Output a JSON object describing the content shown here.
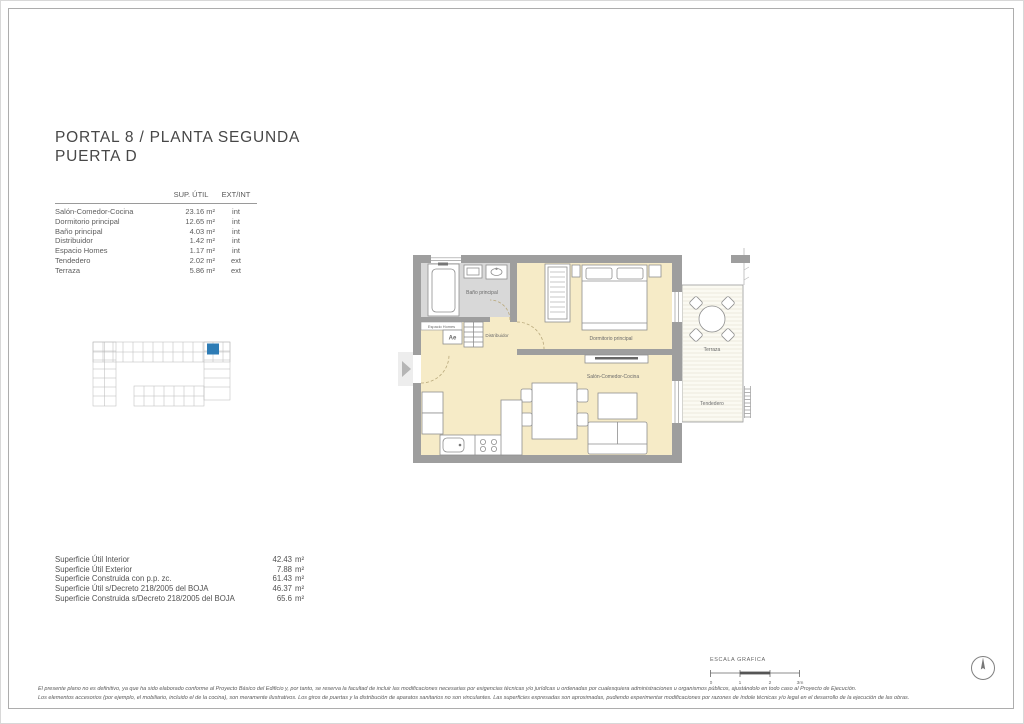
{
  "header": {
    "title_line1": "PORTAL 8 / PLANTA SEGUNDA",
    "title_line2": "PUERTA D"
  },
  "areas_table": {
    "col_sup_util": "SUP. ÚTIL",
    "col_ext_int": "EXT/INT",
    "rows": [
      {
        "name": "Salón-Comedor-Cocina",
        "value": "23.16 m²",
        "type": "int"
      },
      {
        "name": "Dormitorio principal",
        "value": "12.65 m²",
        "type": "int"
      },
      {
        "name": "Baño principal",
        "value": "4.03 m²",
        "type": "int"
      },
      {
        "name": "Distribuidor",
        "value": "1.42 m²",
        "type": "int"
      },
      {
        "name": "Espacio Homes",
        "value": "1.17 m²",
        "type": "int"
      },
      {
        "name": "Tendedero",
        "value": "2.02 m²",
        "type": "ext"
      },
      {
        "name": "Terraza",
        "value": "5.86 m²",
        "type": "ext"
      }
    ]
  },
  "summary_table": {
    "rows": [
      {
        "label": "Superficie Útil Interior",
        "value": "42.43",
        "unit": "m²"
      },
      {
        "label": "Superficie Útil Exterior",
        "value": "7.88",
        "unit": "m²"
      },
      {
        "label": "Superficie Construida con p.p. zc.",
        "value": "61.43",
        "unit": "m²"
      },
      {
        "label": "Superficie Útil s/Decreto 218/2005 del BOJA",
        "value": "46.37",
        "unit": "m²"
      },
      {
        "label": "Superficie Construida s/Decreto 218/2005 del BOJA",
        "value": "65.6",
        "unit": "m²"
      }
    ]
  },
  "floor_plan": {
    "labels": {
      "bathroom": "Baño principal",
      "espacio": "Espacio Homes",
      "espacio_code": "Ae",
      "hall": "Distribuidor",
      "bedroom": "Dormitorio principal",
      "living": "Salón-Comedor-Cocina",
      "terrace": "Terraza",
      "drying": "Tendedero"
    }
  },
  "scale_bar": {
    "title": "ESCALA GRAFICA",
    "ticks": [
      "0",
      "1",
      "2",
      "3m"
    ]
  },
  "footer": {
    "line1": "El presente plano no es definitivo, ya que ha sido elaborado conforme al Proyecto Básico del Edificio y, por tanto, se reserva la facultad de incluir las modificaciones necesarias por exigencias técnicas y/o jurídicas u ordenadas por cualesquiera administraciones u organismos públicos, ajustándolo en todo caso al Proyecto de Ejecución.",
    "line2": "Los elementos accesorios (por ejemplo, el mobiliario, incluido el de la cocina), son meramente ilustrativos. Los giros de puertas y la distribución de aparatos sanitarios no son vinculantes. Las superficies expresadas son aproximadas, pudiendo experimentar modificaciones por razones de índole técnicas y/o legal en el desarrollo de la ejecución de las obras."
  },
  "colors": {
    "highlight_blue": "#2e7cb5",
    "floor_cream": "#f6ebc7",
    "wall_gray": "#9e9e9e",
    "bath_floor_gray": "#d8d8d8"
  }
}
